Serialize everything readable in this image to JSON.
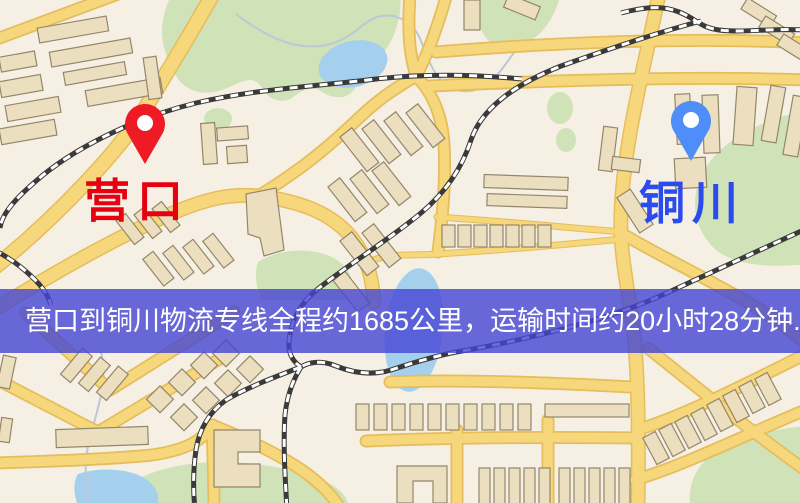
{
  "map": {
    "background_color": "#f6f0e4",
    "road_color": "#f6d77b",
    "park_color": "#cfe2b8",
    "water_color": "#a5d0ed",
    "railway_color": "#3a3a3a",
    "building_color": "#ecdfbf"
  },
  "markers": {
    "origin": {
      "label": "营口",
      "pin_icon": "red-map-pin",
      "pin_color": "#ee1b24",
      "label_color": "#e60012"
    },
    "destination": {
      "label": "铜川",
      "pin_icon": "blue-map-pin",
      "pin_color": "#4f8ef8",
      "label_color": "#2b4bee"
    }
  },
  "banner": {
    "text": "营口到铜川物流专线全程约1685公里，运输时间约20小时28分钟.",
    "background_color": "#4545d4",
    "text_color": "#ffffff"
  }
}
